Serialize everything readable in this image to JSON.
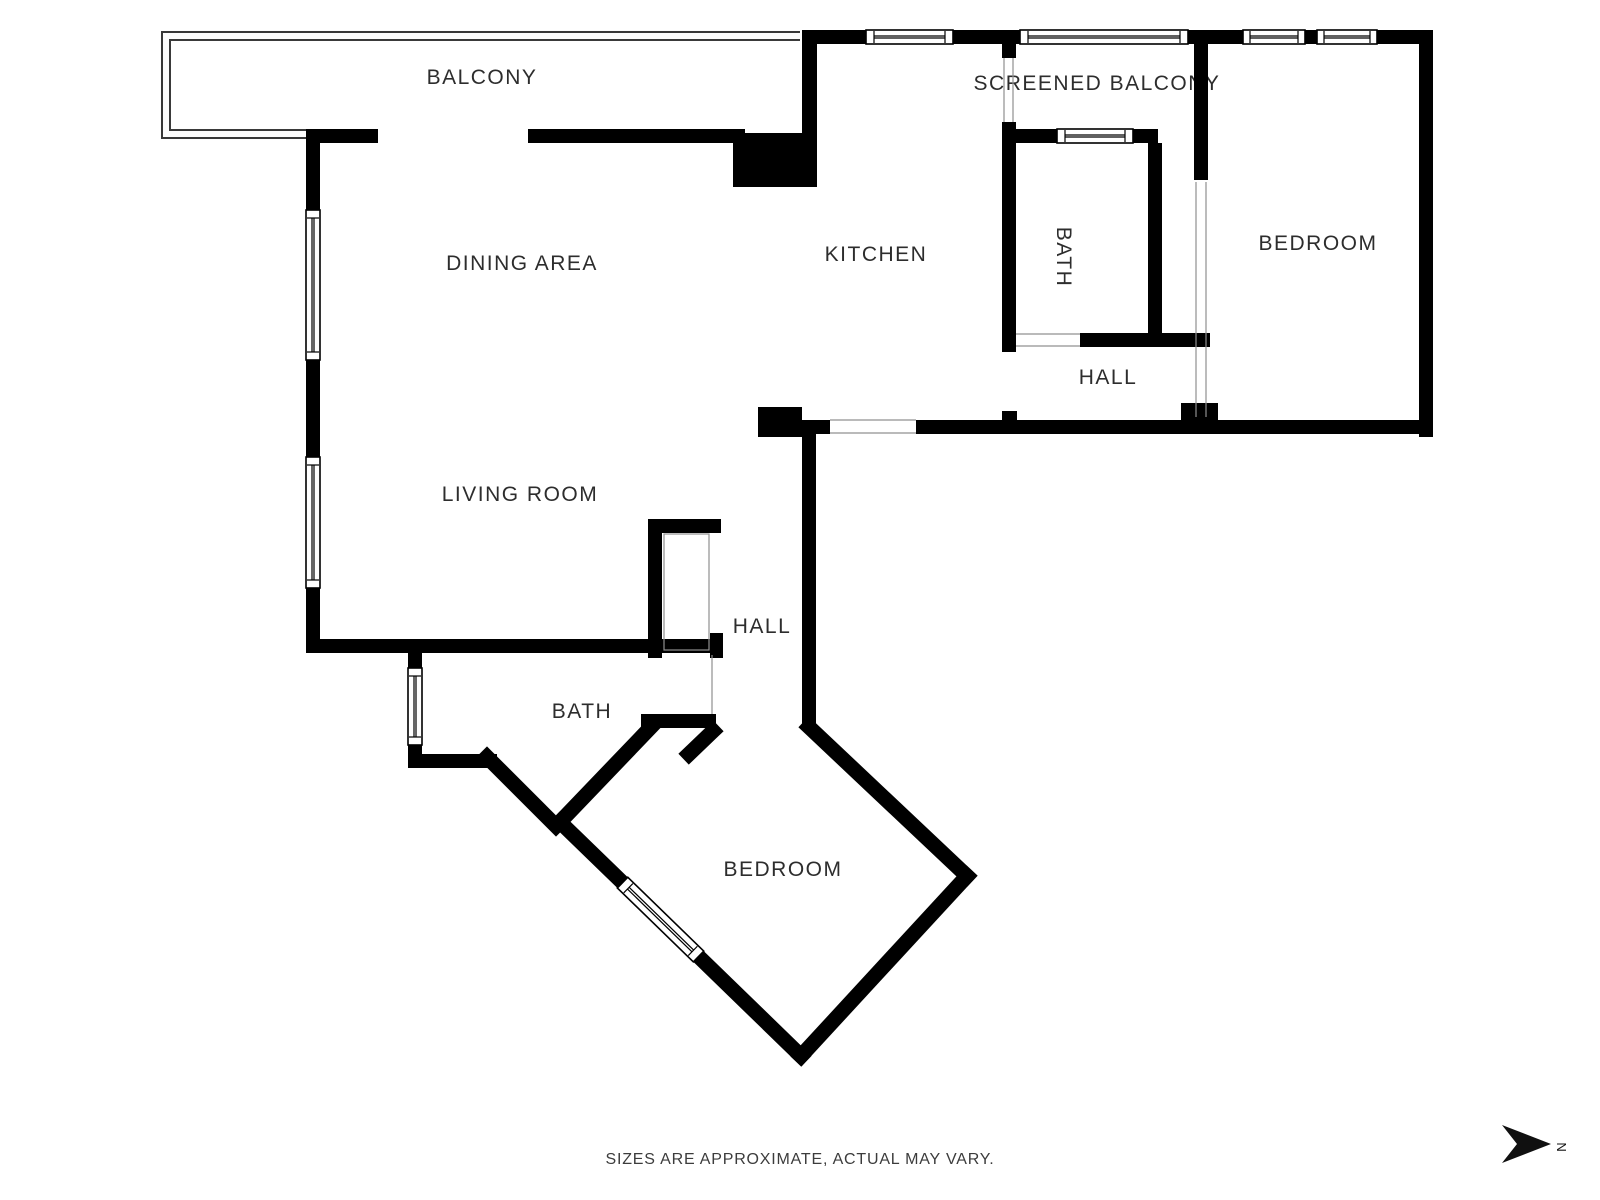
{
  "rooms": {
    "balcony": "BALCONY",
    "screened_balcony": "SCREENED BALCONY",
    "dining_area": "DINING AREA",
    "kitchen": "KITCHEN",
    "bath_top": "BATH",
    "bedroom_right": "BEDROOM",
    "hall_top": "HALL",
    "living_room": "LIVING ROOM",
    "hall_center": "HALL",
    "bath_bottom": "BATH",
    "bedroom_bottom": "BEDROOM"
  },
  "footer": {
    "disclaimer": "SIZES ARE APPROXIMATE, ACTUAL MAY VARY."
  },
  "compass": {
    "north_label": "N"
  },
  "colors": {
    "background": "#ffffff",
    "wall": "#000000",
    "label": "#2d2d2d",
    "balcony_outline": "#3a3a3a",
    "door_line": "#909090"
  }
}
